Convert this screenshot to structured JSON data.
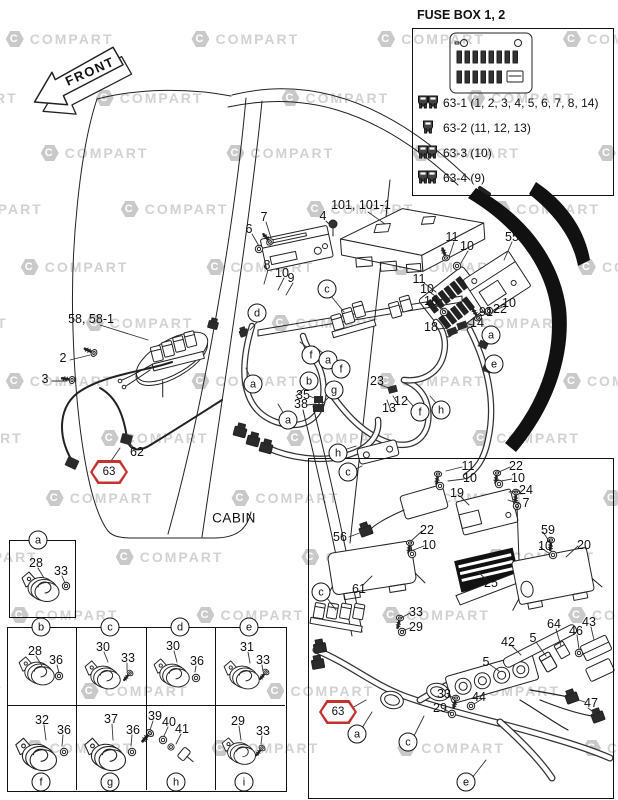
{
  "front": {
    "label": "FRONT"
  },
  "cabin_label": "CABIN",
  "fuse_box_panel": {
    "title": "FUSE BOX 1, 2",
    "legend": [
      {
        "id": "63-1",
        "fuses": "(1, 2, 3, 4, 5, 6, 7, 8, 14)"
      },
      {
        "id": "63-2",
        "fuses": "(11, 12, 13)"
      },
      {
        "id": "63-3",
        "fuses": "(10)"
      },
      {
        "id": "63-4",
        "fuses": "(9)"
      }
    ]
  },
  "watermark": {
    "text": "COMPART",
    "logo": "C",
    "rows": [
      {
        "y": 31,
        "dx": -60
      },
      {
        "y": 90,
        "dx": 30
      },
      {
        "y": 145,
        "dx": -25
      },
      {
        "y": 201,
        "dx": 55
      },
      {
        "y": 259,
        "dx": -45
      },
      {
        "y": 315,
        "dx": 20
      },
      {
        "y": 373,
        "dx": -60
      },
      {
        "y": 430,
        "dx": 35
      },
      {
        "y": 490,
        "dx": -20
      },
      {
        "y": 549,
        "dx": 50
      },
      {
        "y": 607,
        "dx": -55
      },
      {
        "y": 683,
        "dx": 15
      },
      {
        "y": 740,
        "dx": -40
      }
    ]
  },
  "red_callouts": [
    {
      "t": "63",
      "x": 109,
      "y": 472
    },
    {
      "t": "63",
      "x": 338,
      "y": 712
    }
  ],
  "callouts": [
    {
      "t": "101, 101-1",
      "x": 361,
      "y": 205
    },
    {
      "t": "4",
      "x": 323,
      "y": 216
    },
    {
      "t": "7",
      "x": 264,
      "y": 217
    },
    {
      "t": "6",
      "x": 249,
      "y": 229
    },
    {
      "t": "8",
      "x": 267,
      "y": 265
    },
    {
      "t": "10",
      "x": 282,
      "y": 273
    },
    {
      "t": "9",
      "x": 291,
      "y": 278
    },
    {
      "t": "11",
      "x": 452,
      "y": 237
    },
    {
      "t": "10",
      "x": 467,
      "y": 246
    },
    {
      "t": "55",
      "x": 512,
      "y": 237
    },
    {
      "t": "11",
      "x": 419,
      "y": 279
    },
    {
      "t": "10",
      "x": 427,
      "y": 289
    },
    {
      "t": "16",
      "x": 431,
      "y": 301
    },
    {
      "t": "18",
      "x": 431,
      "y": 327
    },
    {
      "t": "10",
      "x": 509,
      "y": 303
    },
    {
      "t": "22",
      "x": 500,
      "y": 309
    },
    {
      "t": "91",
      "x": 486,
      "y": 312
    },
    {
      "t": "14",
      "x": 477,
      "y": 323
    },
    {
      "t": "58, 58-1",
      "x": 91,
      "y": 319
    },
    {
      "t": "2",
      "x": 63,
      "y": 358
    },
    {
      "t": "3",
      "x": 45,
      "y": 379
    },
    {
      "t": "62",
      "x": 137,
      "y": 452
    },
    {
      "t": "35",
      "x": 303,
      "y": 395
    },
    {
      "t": "38",
      "x": 301,
      "y": 404
    },
    {
      "t": "23",
      "x": 377,
      "y": 381
    },
    {
      "t": "12",
      "x": 401,
      "y": 401
    },
    {
      "t": "13",
      "x": 389,
      "y": 408
    },
    {
      "t": "11",
      "x": 468,
      "y": 466
    },
    {
      "t": "10",
      "x": 470,
      "y": 478
    },
    {
      "t": "22",
      "x": 516,
      "y": 466
    },
    {
      "t": "10",
      "x": 518,
      "y": 478
    },
    {
      "t": "24",
      "x": 526,
      "y": 490
    },
    {
      "t": "7",
      "x": 526,
      "y": 503
    },
    {
      "t": "19",
      "x": 457,
      "y": 493
    },
    {
      "t": "56",
      "x": 340,
      "y": 537
    },
    {
      "t": "22",
      "x": 427,
      "y": 530
    },
    {
      "t": "10",
      "x": 429,
      "y": 545
    },
    {
      "t": "61",
      "x": 359,
      "y": 589
    },
    {
      "t": "25",
      "x": 491,
      "y": 583
    },
    {
      "t": "59",
      "x": 548,
      "y": 530
    },
    {
      "t": "10",
      "x": 545,
      "y": 546
    },
    {
      "t": "20",
      "x": 584,
      "y": 545
    },
    {
      "t": "33",
      "x": 416,
      "y": 612
    },
    {
      "t": "29",
      "x": 416,
      "y": 627
    },
    {
      "t": "42",
      "x": 508,
      "y": 642
    },
    {
      "t": "5",
      "x": 533,
      "y": 638
    },
    {
      "t": "64",
      "x": 554,
      "y": 624
    },
    {
      "t": "46",
      "x": 576,
      "y": 631
    },
    {
      "t": "43",
      "x": 589,
      "y": 622
    },
    {
      "t": "5",
      "x": 486,
      "y": 662
    },
    {
      "t": "33",
      "x": 444,
      "y": 694
    },
    {
      "t": "44",
      "x": 479,
      "y": 697
    },
    {
      "t": "29",
      "x": 440,
      "y": 708
    },
    {
      "t": "47",
      "x": 591,
      "y": 703
    },
    {
      "t": "28",
      "x": 36,
      "y": 563
    },
    {
      "t": "33",
      "x": 61,
      "y": 571
    },
    {
      "t": "28",
      "x": 35,
      "y": 651
    },
    {
      "t": "36",
      "x": 56,
      "y": 660
    },
    {
      "t": "30",
      "x": 103,
      "y": 647
    },
    {
      "t": "33",
      "x": 128,
      "y": 658
    },
    {
      "t": "30",
      "x": 173,
      "y": 646
    },
    {
      "t": "36",
      "x": 197,
      "y": 661
    },
    {
      "t": "31",
      "x": 247,
      "y": 647
    },
    {
      "t": "33",
      "x": 263,
      "y": 660
    },
    {
      "t": "32",
      "x": 42,
      "y": 720
    },
    {
      "t": "36",
      "x": 64,
      "y": 730
    },
    {
      "t": "37",
      "x": 111,
      "y": 719
    },
    {
      "t": "36",
      "x": 133,
      "y": 730
    },
    {
      "t": "39",
      "x": 155,
      "y": 716
    },
    {
      "t": "40",
      "x": 169,
      "y": 722
    },
    {
      "t": "41",
      "x": 182,
      "y": 729
    },
    {
      "t": "29",
      "x": 238,
      "y": 721
    },
    {
      "t": "33",
      "x": 263,
      "y": 731
    }
  ],
  "letters": [
    {
      "t": "c",
      "x": 327,
      "y": 289
    },
    {
      "t": "d",
      "x": 257,
      "y": 313
    },
    {
      "t": "f",
      "x": 311,
      "y": 355
    },
    {
      "t": "a",
      "x": 328,
      "y": 360
    },
    {
      "t": "f",
      "x": 341,
      "y": 369
    },
    {
      "t": "b",
      "x": 309,
      "y": 381
    },
    {
      "t": "g",
      "x": 334,
      "y": 390
    },
    {
      "t": "a",
      "x": 253,
      "y": 384
    },
    {
      "t": "a",
      "x": 288,
      "y": 420
    },
    {
      "t": "f",
      "x": 420,
      "y": 412
    },
    {
      "t": "h",
      "x": 441,
      "y": 410
    },
    {
      "t": "a",
      "x": 491,
      "y": 335
    },
    {
      "t": "e",
      "x": 494,
      "y": 364
    },
    {
      "t": "h",
      "x": 338,
      "y": 453
    },
    {
      "t": "c",
      "x": 348,
      "y": 472
    },
    {
      "t": "c",
      "x": 321,
      "y": 592
    },
    {
      "t": "a",
      "x": 357,
      "y": 734
    },
    {
      "t": "c",
      "x": 408,
      "y": 742
    },
    {
      "t": "e",
      "x": 466,
      "y": 782
    },
    {
      "t": "a",
      "x": 38,
      "y": 540
    },
    {
      "t": "b",
      "x": 41,
      "y": 627
    },
    {
      "t": "c",
      "x": 110,
      "y": 627
    },
    {
      "t": "d",
      "x": 180,
      "y": 627
    },
    {
      "t": "e",
      "x": 249,
      "y": 627
    },
    {
      "t": "f",
      "x": 41,
      "y": 782
    },
    {
      "t": "g",
      "x": 110,
      "y": 782
    },
    {
      "t": "h",
      "x": 176,
      "y": 782
    },
    {
      "t": "i",
      "x": 244,
      "y": 782
    }
  ]
}
